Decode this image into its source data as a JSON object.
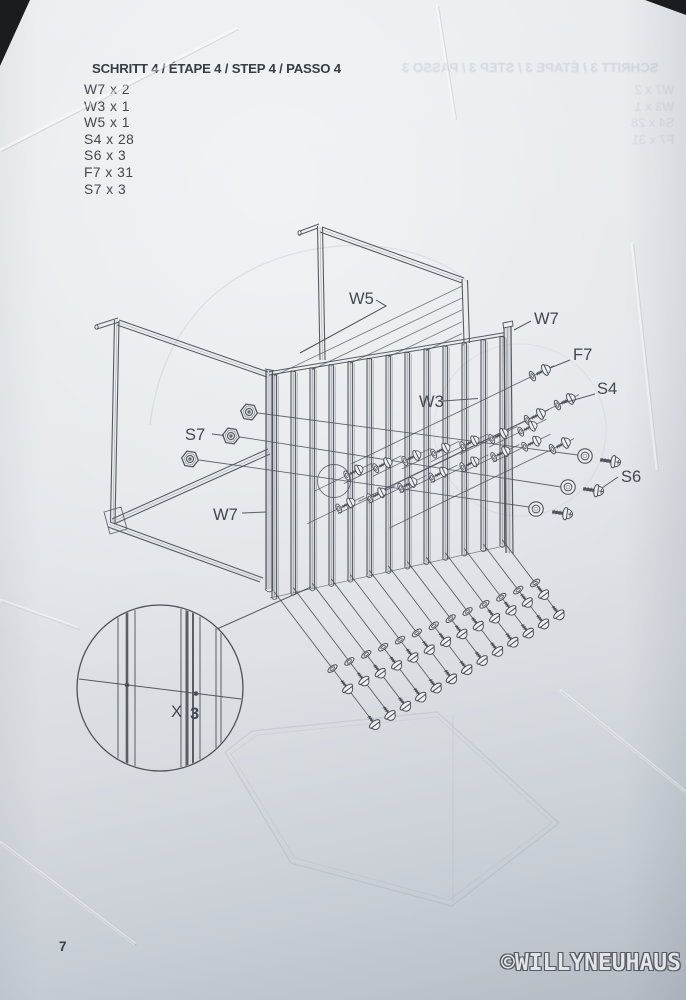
{
  "page": {
    "step_title": "SCHRITT 4 / ÉTAPE 4 / STEP 4 / PASSO 4",
    "parts_list": [
      "W7 x 2",
      "W3 x 1",
      "W5 x 1",
      "S4 x 28",
      "S6 x 3",
      "F7 x 31",
      "S7 x 3"
    ],
    "page_number": "7",
    "watermark": "©WILLYNEUHAUS"
  },
  "bleed_through": {
    "title": "SCHRITT 3 / ÉTAPE 3 / STEP 3 / PASSO 3",
    "lines": [
      "W7 x 2",
      "W3 x 1",
      "S4 x 28",
      "F7 x 31"
    ]
  },
  "diagram": {
    "labels": {
      "top_rail": "W5",
      "right_post": "W7",
      "screw": "F7",
      "washer_screw": "S4",
      "mid_panel": "W3",
      "bolt": "S6",
      "nut": "S7",
      "left_post": "W7"
    },
    "detail": {
      "prefix": "X",
      "count": "3"
    },
    "ink_color": "#4b5057",
    "paper_color": "#e4e7ea"
  }
}
